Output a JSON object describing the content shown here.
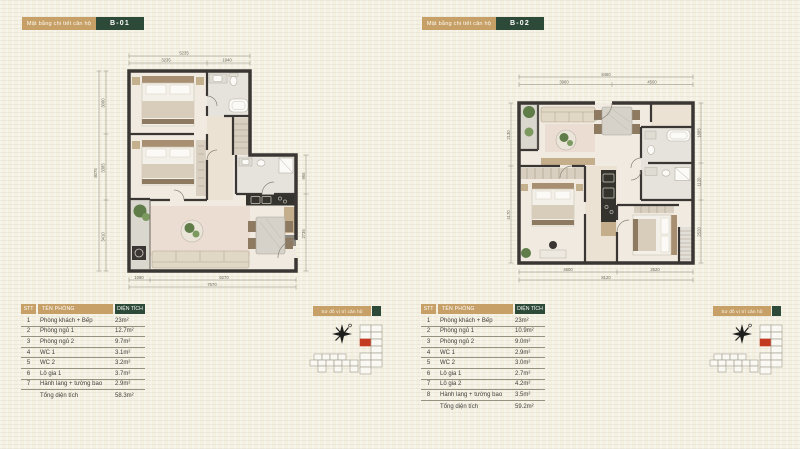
{
  "colors": {
    "accent_tan": "#C7A067",
    "accent_green": "#2D4A39",
    "unit_red": "#C43A20",
    "paper": "#F4F0E2"
  },
  "b01": {
    "header_label": "Mặt bằng chi tiết căn hộ",
    "unit_code": "B-01",
    "minimap_label": "Sơ đồ vị trí căn hộ",
    "table": {
      "headers": {
        "stt": "STT",
        "name": "TÊN PHÒNG",
        "area": "DIỆN TÍCH"
      },
      "rows": [
        {
          "stt": "1",
          "name": "Phòng khách + Bếp",
          "area": "23m²"
        },
        {
          "stt": "2",
          "name": "Phòng ngủ 1",
          "area": "12.7m²"
        },
        {
          "stt": "3",
          "name": "Phòng ngủ 2",
          "area": "9.7m²"
        },
        {
          "stt": "4",
          "name": "WC 1",
          "area": "3.1m²"
        },
        {
          "stt": "5",
          "name": "WC 2",
          "area": "3.2m²"
        },
        {
          "stt": "6",
          "name": "Lô gia 1",
          "area": "3.7m²"
        },
        {
          "stt": "7",
          "name": "Hành lang + tường bao",
          "area": "2.9m²"
        }
      ],
      "total_label": "Tổng diện tích",
      "total_area": "58.3m²"
    },
    "dims": {
      "top": [
        "5235",
        "3235",
        "1940"
      ],
      "left": [
        "8075",
        "3080",
        "3385",
        "3410"
      ],
      "right": [
        "965",
        "2735"
      ],
      "bottom": [
        "7570",
        "1080",
        "6270"
      ]
    }
  },
  "b02": {
    "header_label": "Mặt bằng chi tiết căn hộ",
    "unit_code": "B-02",
    "minimap_label": "Sơ đồ vị trí căn hộ",
    "table": {
      "headers": {
        "stt": "STT",
        "name": "TÊN PHÒNG",
        "area": "DIỆN TÍCH"
      },
      "rows": [
        {
          "stt": "1",
          "name": "Phòng khách + Bếp",
          "area": "23m²"
        },
        {
          "stt": "2",
          "name": "Phòng ngủ 1",
          "area": "10.9m²"
        },
        {
          "stt": "3",
          "name": "Phòng ngủ 2",
          "area": "9.0m²"
        },
        {
          "stt": "4",
          "name": "WC 1",
          "area": "2.9m²"
        },
        {
          "stt": "5",
          "name": "WC 2",
          "area": "3.0m²"
        },
        {
          "stt": "6",
          "name": "Lô gia 1",
          "area": "2.7m²"
        },
        {
          "stt": "7",
          "name": "Lô gia 2",
          "area": "4.2m²"
        },
        {
          "stt": "8",
          "name": "Hành lang + tường bao",
          "area": "3.5m²"
        }
      ],
      "total_label": "Tổng diện tích",
      "total_area": "59.2m²"
    },
    "dims": {
      "top": [
        "8460",
        "3960",
        "4500"
      ],
      "left": [
        "2130",
        "4170"
      ],
      "right": [
        "1885",
        "1120",
        "2520"
      ],
      "bottom": [
        "8120",
        "4600",
        "2520"
      ]
    }
  }
}
